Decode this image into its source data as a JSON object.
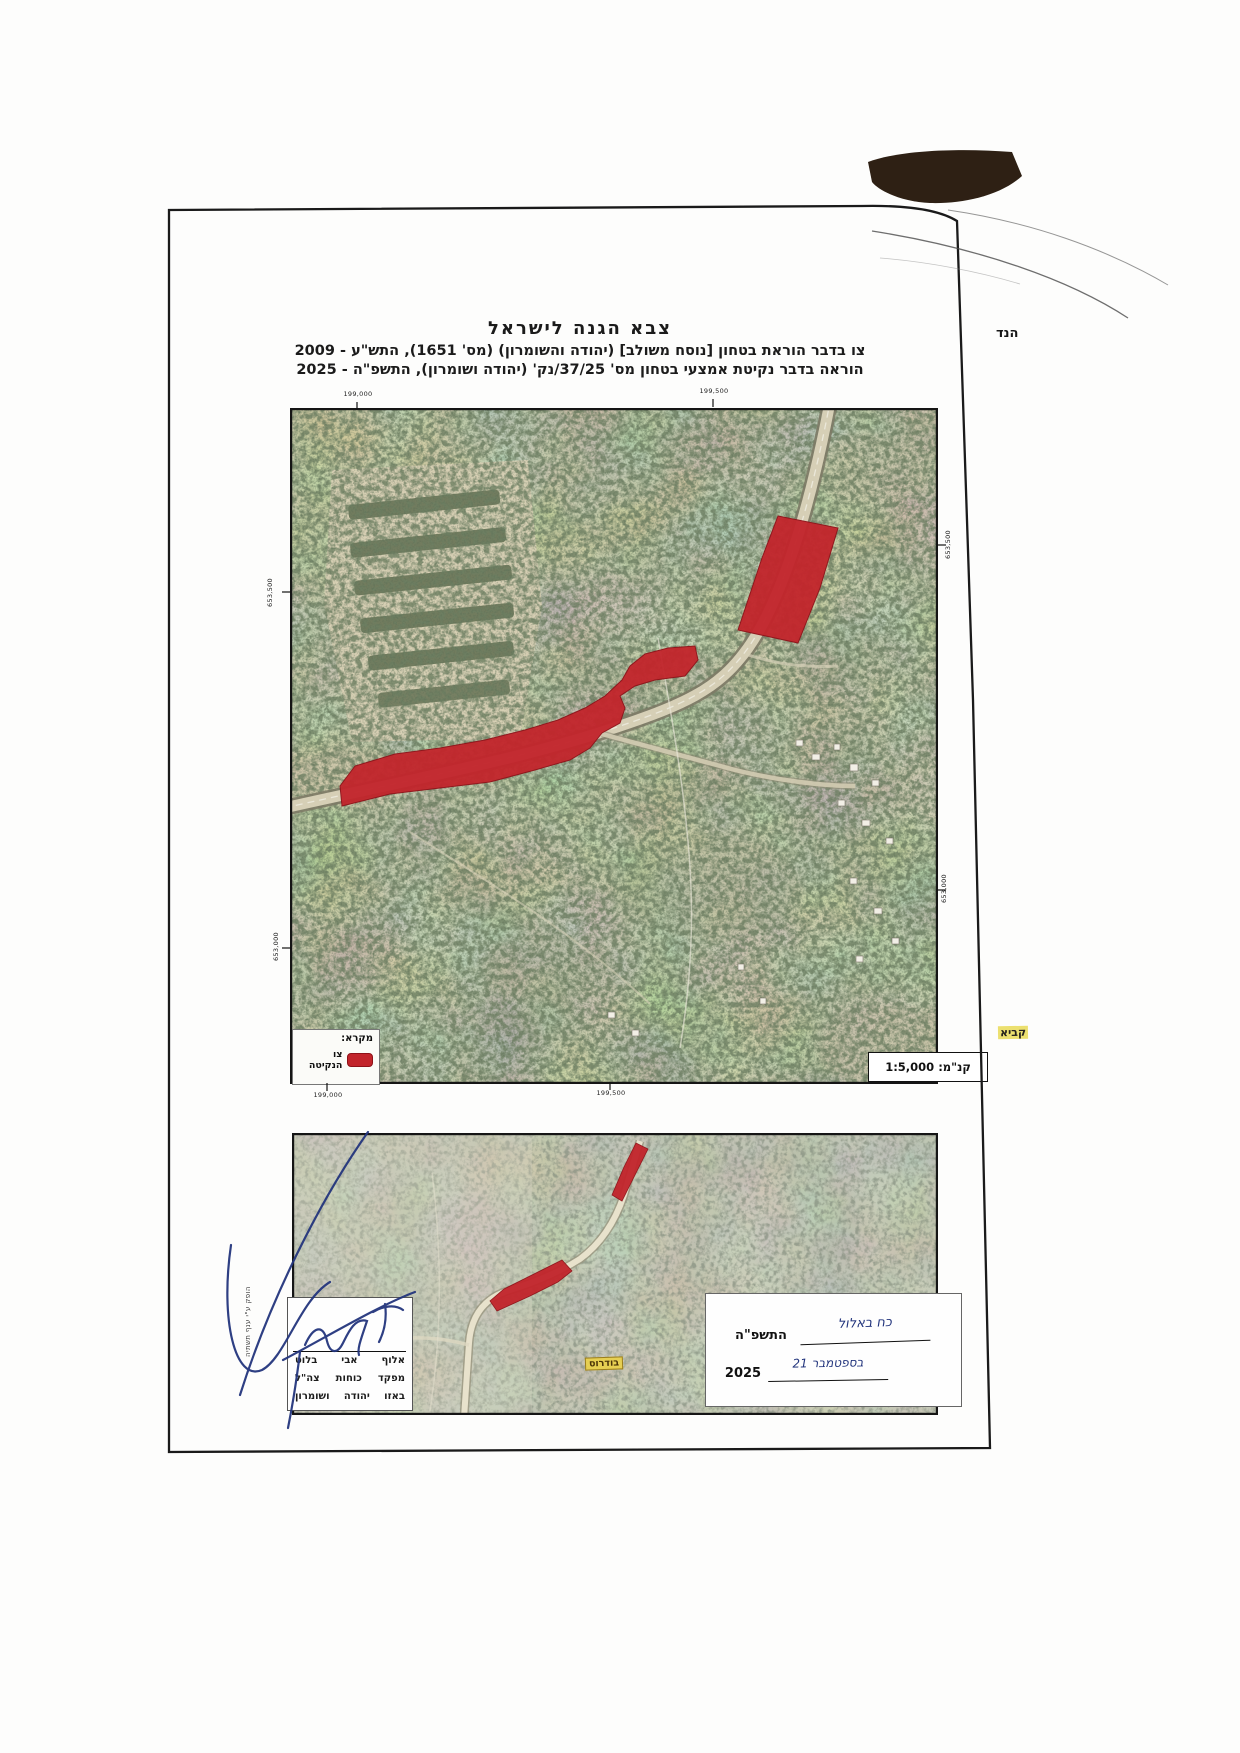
{
  "header": {
    "army": "צבא הגנה לישראל",
    "order_line": "צו בדבר הוראת בטחון [נוסח משולב] (יהודה והשומרון) (מס' 1651), התש\"ע - 2009",
    "instruction_line": "הוראה בדבר נקיטת אמצעי בטחון מס' 37/25/נק' (יהודה ושומרון), התשפ\"ה - 2025"
  },
  "map_top": {
    "grid_labels": {
      "top_left": "199,000",
      "top_right": "199,500",
      "bottom_left": "199,000",
      "bottom_right": "199,500",
      "left_upper": "653,500",
      "left_lower": "653,000",
      "right_upper": "653,500",
      "right_lower": "653,000"
    },
    "legend": {
      "title": "מקרא:",
      "item_label": "צו הנקיטה",
      "swatch_color": "#c2242b"
    },
    "scale_label": "קנ\"מ: 1:5,000"
  },
  "map_bottom": {
    "place_labels": {
      "budrus": "בודרוס",
      "qibya": "קביא"
    }
  },
  "signature_block": {
    "rank_name": "אלוף אבי בלוט",
    "title_line": "מפקד כוחות צה\"ל",
    "region_line": "באזו יהודה ושומרון"
  },
  "date_block": {
    "hebrew_date_handwritten": "כח באלול",
    "hebrew_year_printed": "התשפ\"ה",
    "gregorian_date_handwritten": "21 בספטמבר",
    "gregorian_year_printed": "2025"
  },
  "margin_notes": {
    "right_edge_note": "הנד",
    "left_vertical_note": "הופק ע\"י ענף תשתיה"
  },
  "colors": {
    "overlay_red": "#c2242b",
    "overlay_red_border": "#8e1118",
    "signature_ink": "#23357d",
    "place_label_bg": "#e6cf52"
  }
}
